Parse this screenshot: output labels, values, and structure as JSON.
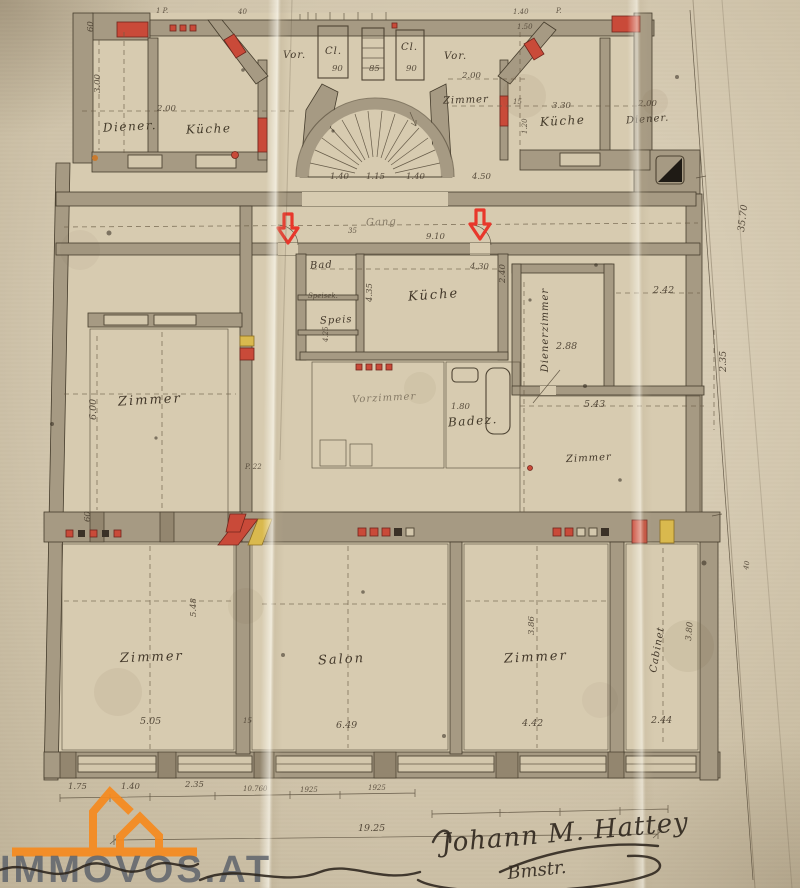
{
  "watermark": {
    "text": "IMMOVOS.AT"
  },
  "signature": {
    "name": "Johann M. Hattey",
    "title": "Bmstr."
  },
  "colors": {
    "arrow_red": "#e8372b",
    "flue_red": "#c94a39",
    "accent_yellow": "#d9b94e",
    "watermark_orange": "#f68a1e",
    "paper": "#cfc2a5",
    "wall_poche": "#a69a83"
  },
  "rooms": [
    {
      "label": "Diener."
    },
    {
      "label": "Küche"
    },
    {
      "label": "Vor."
    },
    {
      "label": "Cl."
    },
    {
      "label": "Cl."
    },
    {
      "label": "Vor."
    },
    {
      "label": "Zimmer"
    },
    {
      "label": "Küche"
    },
    {
      "label": "Diener."
    },
    {
      "label": "Gang"
    },
    {
      "label": "Bad"
    },
    {
      "label": "Speisek."
    },
    {
      "label": "Speis"
    },
    {
      "label": "Küche"
    },
    {
      "label": "Vorzimmer"
    },
    {
      "label": "Badez."
    },
    {
      "label": "Dienerzimmer"
    },
    {
      "label": "Zimmer"
    },
    {
      "label": "Zimmer"
    },
    {
      "label": "Zimmer"
    },
    {
      "label": "Salon"
    },
    {
      "label": "Zimmer"
    },
    {
      "label": "Cabinet"
    }
  ],
  "dims": [
    "60",
    "3.00",
    "2.00",
    "90",
    "85",
    "90",
    "2.00",
    "3.30",
    "2.00",
    "15",
    "1.20",
    "1.40",
    "1.15",
    "1.40",
    "4.50",
    "9.10",
    "35",
    "4.30",
    "4.35",
    "4.25",
    "2.88",
    "2.40",
    "2.42",
    "5.43",
    "1.80",
    "6.00",
    "60",
    "35.70",
    "2.35",
    "5.48",
    "5.05",
    "6.49",
    "3.86",
    "4.42",
    "2.44",
    "3.80",
    "1.75",
    "1.40",
    "2.35",
    "10.760",
    "1925",
    "1925",
    "19.25",
    "1.40",
    "1.50",
    "40",
    "15",
    "P. 22",
    "1 P.",
    "40",
    "P."
  ]
}
